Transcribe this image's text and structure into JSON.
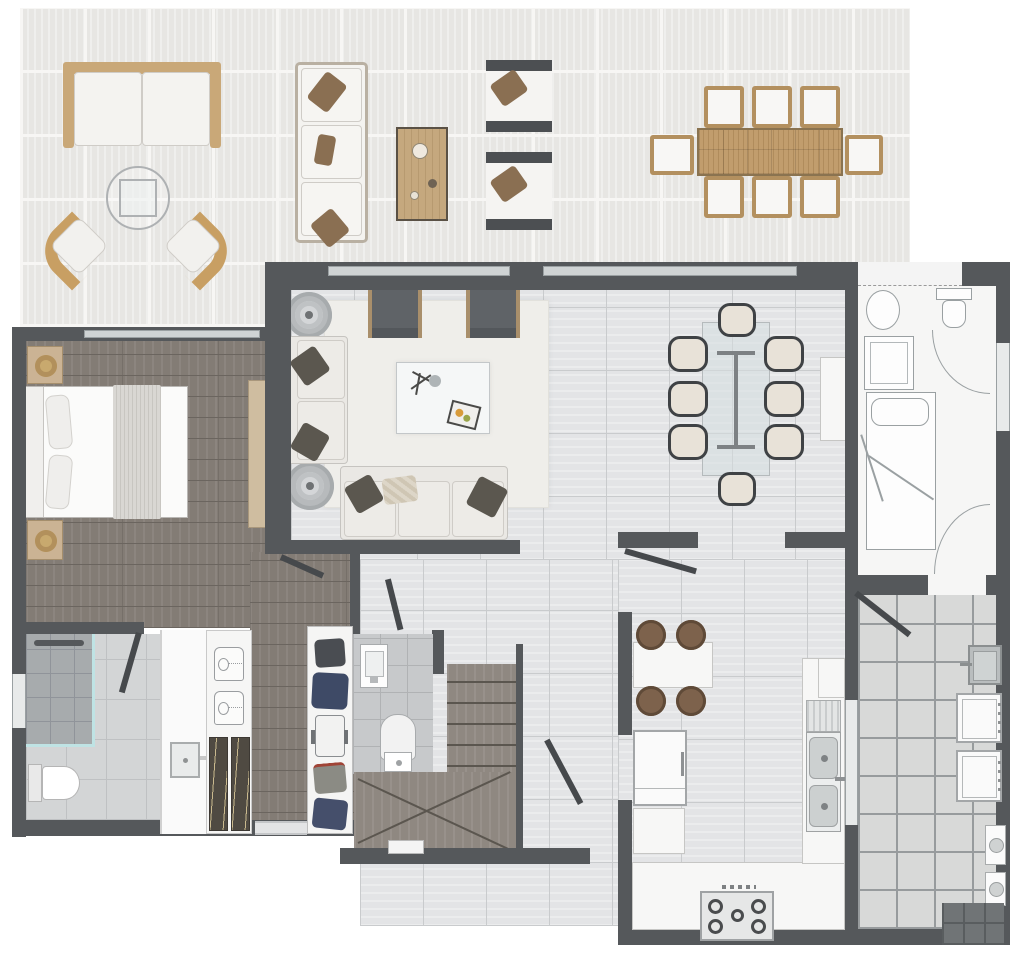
{
  "meta": {
    "title": "Apartment floor plan (top-down 3D render)",
    "canvas": {
      "width": 1024,
      "height": 958
    },
    "visible_text": "none – the drawing contains no labels, dimensions or text"
  },
  "palette": {
    "wall": "#55585b",
    "terrace_tile": "#e7e6e3",
    "interior_tile": "#e3e4e6",
    "wood_floor": "#837c75",
    "stair_wood": "#8f8881",
    "bath_tile": "#d3d5d6",
    "shower_tile": "#a7abad",
    "patio_tile": "#d8d9d8",
    "outdoor_wood": "#c19d6d",
    "rattan": "#c89f63",
    "sofa_fabric": "#edebe7",
    "accent_pillow": "#5b574f",
    "glass_teal": "#bfe3e4",
    "rug": "#efeeea",
    "navy_cloth": "#3e4a66"
  },
  "rooms": [
    {
      "name": "terrace",
      "floor": "light outdoor tile",
      "furniture": [
        "outdoor sofa",
        "round side table with glass top",
        "2 wicker lounge chairs",
        "outdoor sofa (vertical)",
        "wooden coffee table",
        "2 outdoor armchairs",
        "outdoor dining table with 8 chairs"
      ]
    },
    {
      "name": "living-room",
      "floor": "large light tile",
      "furniture": [
        "2 dark armchairs",
        "2-seat sofa",
        "3-seat sofa",
        "2 round side tables with lamps",
        "white coffee table with decor tray",
        "area rug"
      ]
    },
    {
      "name": "dining-area",
      "floor": "large light tile",
      "furniture": [
        "glass dining table with metal base",
        "8 chairs (dark frame, cream seat)",
        "white sideboard"
      ]
    },
    {
      "name": "master-bedroom",
      "floor": "dark wood planks",
      "furniture": [
        "double bed with throw blanket",
        "2 nightstands with lamps",
        "TV console with TV"
      ]
    },
    {
      "name": "master-bathroom",
      "floor": "grey tile",
      "furniture": [
        "walk-in shower with glass screen and linear drain",
        "toilet",
        "vanity with sink"
      ]
    },
    {
      "name": "wardrobe-closets",
      "floor": "wood",
      "furniture": [
        "closet with 2 folded shirts and hanging clothes",
        "hall closet with folded clothes and suitcase"
      ]
    },
    {
      "name": "powder-room",
      "floor": "small grey tile",
      "furniture": [
        "wall-hung basin",
        "toilet"
      ]
    },
    {
      "name": "staircase",
      "floor": "wood treads",
      "furniture": [
        "straight flight of treads",
        "winder treads",
        "handrail wall"
      ]
    },
    {
      "name": "kitchen",
      "floor": "large light tile",
      "furniture": [
        "breakfast table with 4 round stools",
        "refrigerator",
        "base cabinet",
        "U-shaped white counter",
        "5-burner gas hob",
        "double sink with drainboard"
      ]
    },
    {
      "name": "service-patio",
      "floor": "grey outdoor tile",
      "furniture": [
        "laundry sink",
        "washer",
        "dryer",
        "2 gas/heater units",
        "dark tiled step"
      ]
    },
    {
      "name": "service-room-schematic",
      "floor": "unrendered line drawing",
      "furniture": [
        "oval basin",
        "shower cabin",
        "toilet",
        "single bed with pillow",
        "2 swing doors"
      ]
    }
  ],
  "counts": {
    "outdoor_dining_chairs": 8,
    "indoor_dining_chairs": 8,
    "breakfast_stools": 4,
    "gas_burners": 5,
    "door_swings_rendered": 6
  }
}
